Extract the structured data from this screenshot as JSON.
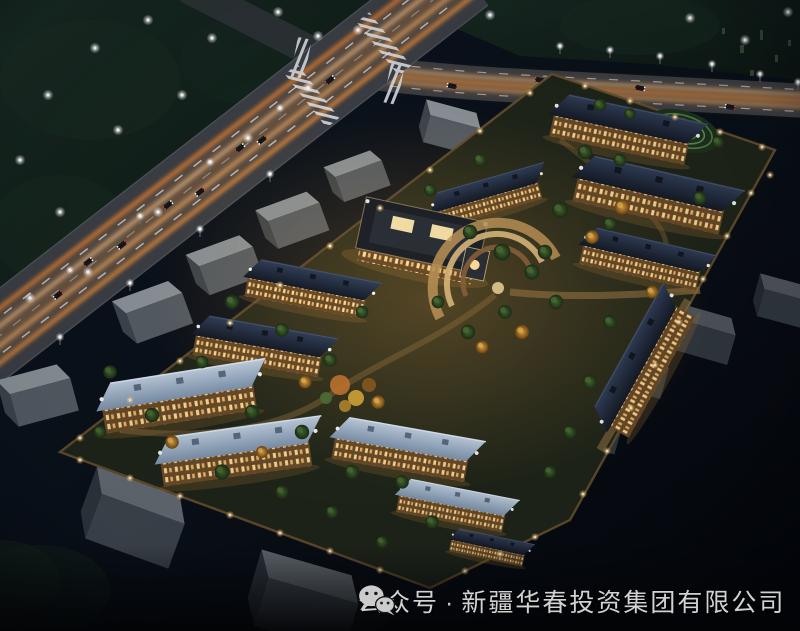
{
  "image": {
    "type": "night aerial architectural rendering",
    "subject": "illuminated residential community master plan beside a lit highway intersection",
    "palette": {
      "sky": "#0a111a",
      "vegetation": "#18271f",
      "road_asphalt": "#3d4046",
      "road_glow": "#ef9a43",
      "light_trail": "#ffc07a",
      "facade_warm": "#6b4c28",
      "window_warm": "#ffdc96",
      "roof_dark": "#222b38",
      "roof_light": "#a9bbd0",
      "tree_green": "#46662f",
      "tree_autumn": "#d99a38",
      "context_building_gray": "#8d959b",
      "lamp_white": "#ffffff",
      "caption_text": "#d2d2d2"
    }
  },
  "watermark": {
    "icon": "wechat-icon",
    "account_type": "公众号",
    "separator": "·",
    "company_name": "新疆华春投资集团有限公司"
  }
}
